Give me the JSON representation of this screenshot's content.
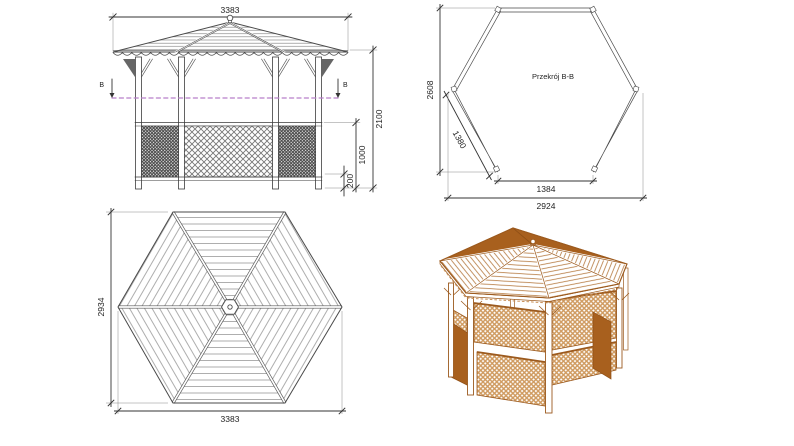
{
  "drawing": {
    "front_elevation": {
      "dim_width": "3383",
      "dim_height_total": "2100",
      "dim_balustrade": "1000",
      "dim_base": "200",
      "section_marker": "B"
    },
    "cross_section": {
      "label": "Przekrój B-B",
      "dim_height": "2608",
      "dim_wall": "1380",
      "dim_opening": "1384",
      "dim_width": "2924"
    },
    "roof_plan": {
      "dim_height": "2934",
      "dim_width": "3383"
    },
    "colors": {
      "line": "#444444",
      "stripe": "#9a9a9a",
      "section_line": "#b87fc9",
      "wood_dark": "#a8601e",
      "wood_line": "#9c5a1e",
      "lattice_tan": "#cf9a5f",
      "fascia_tan": "#c89058"
    }
  }
}
